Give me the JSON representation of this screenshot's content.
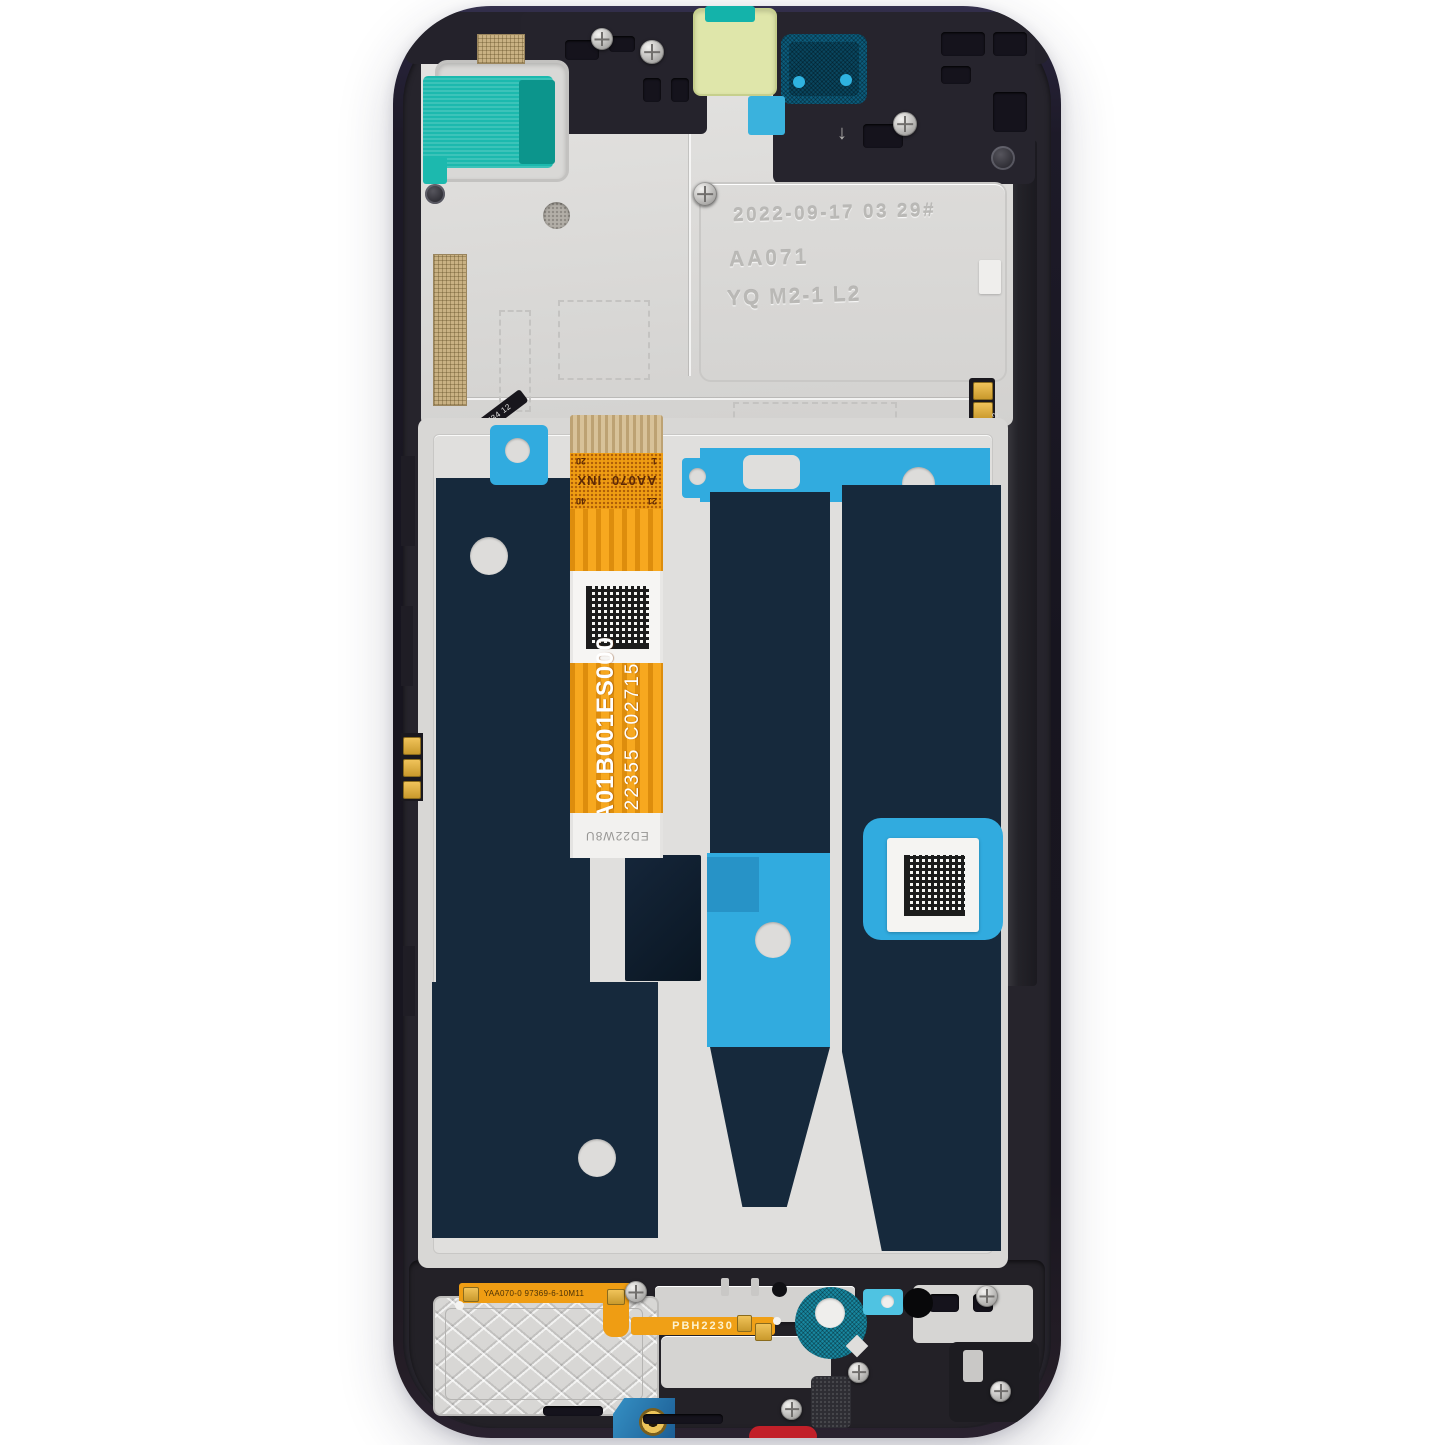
{
  "scene": {
    "type": "product-photo",
    "subject": "Smartphone LCD display assembly with frame - internal rear view (service part)",
    "background_color": "#ffffff"
  },
  "engraving": {
    "date_code": "2022-09-17 03 29#",
    "code_line_2": "AA071",
    "code_line_3": "YQ M2-1 L2",
    "arrow_glyph": "↓"
  },
  "main_flex": {
    "connector_label": "AA070 -INX",
    "pins": {
      "row1_left": "21",
      "row1_right": "40",
      "row2_left": "1",
      "row2_right": "20"
    },
    "part_number": "6A01B001ES000",
    "lot_code": "22355 C02715",
    "end_label": "ED22W8U"
  },
  "side_flex": {
    "left_label": "XL-2237 9734 12",
    "right_label": "9736L12",
    "right_label_2": "C M14"
  },
  "bottom_flex": {
    "left_label": "YAA070-0 97369-6-10M11",
    "right_label": "PBH2230"
  },
  "colors": {
    "frame": "#1c1a26",
    "frame_top_tint": "#34304d",
    "silver_plate": "#dcdbd9",
    "navy_adhesive": "#16293c",
    "cyan_adhesive": "#31abdf",
    "teal_sticker": "#1cb9ae",
    "dark_teal_mesh": "#0c5c7c",
    "orange_flex": "#ef9d13",
    "gold_contact": "#dcae3f",
    "yellow_green_pad": "#dfe6aa",
    "red_gasket": "#c22029"
  }
}
